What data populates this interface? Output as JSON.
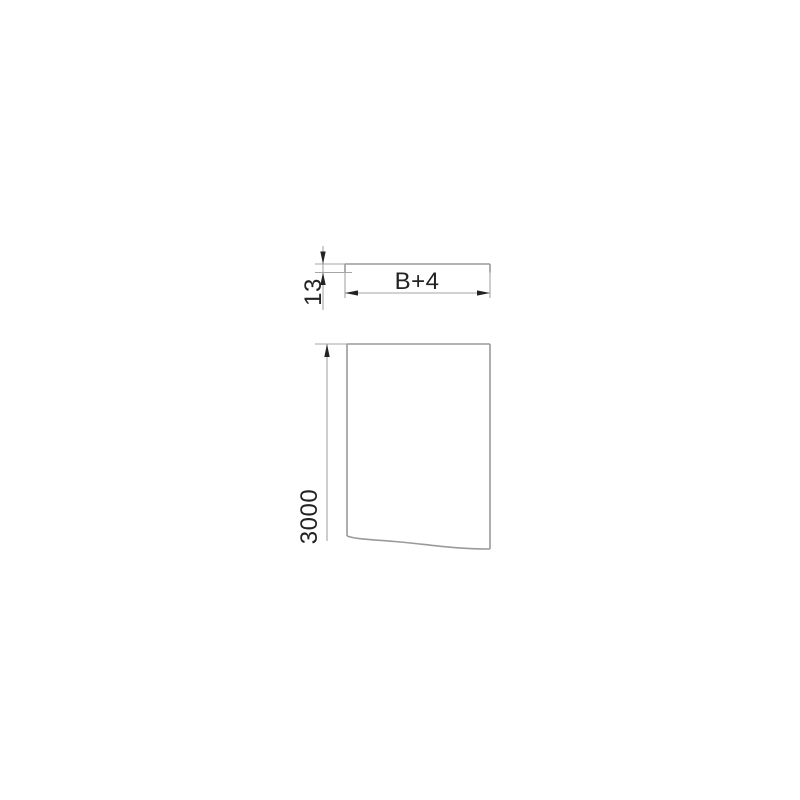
{
  "colors": {
    "background": "#ffffff",
    "part_line": "#9a9a9a",
    "dim_line": "#a6a6a6",
    "annotation": "#232323"
  },
  "top_view": {
    "height_dim": "13",
    "width_dim": "B+4"
  },
  "front_view": {
    "length_dim": "3000"
  }
}
